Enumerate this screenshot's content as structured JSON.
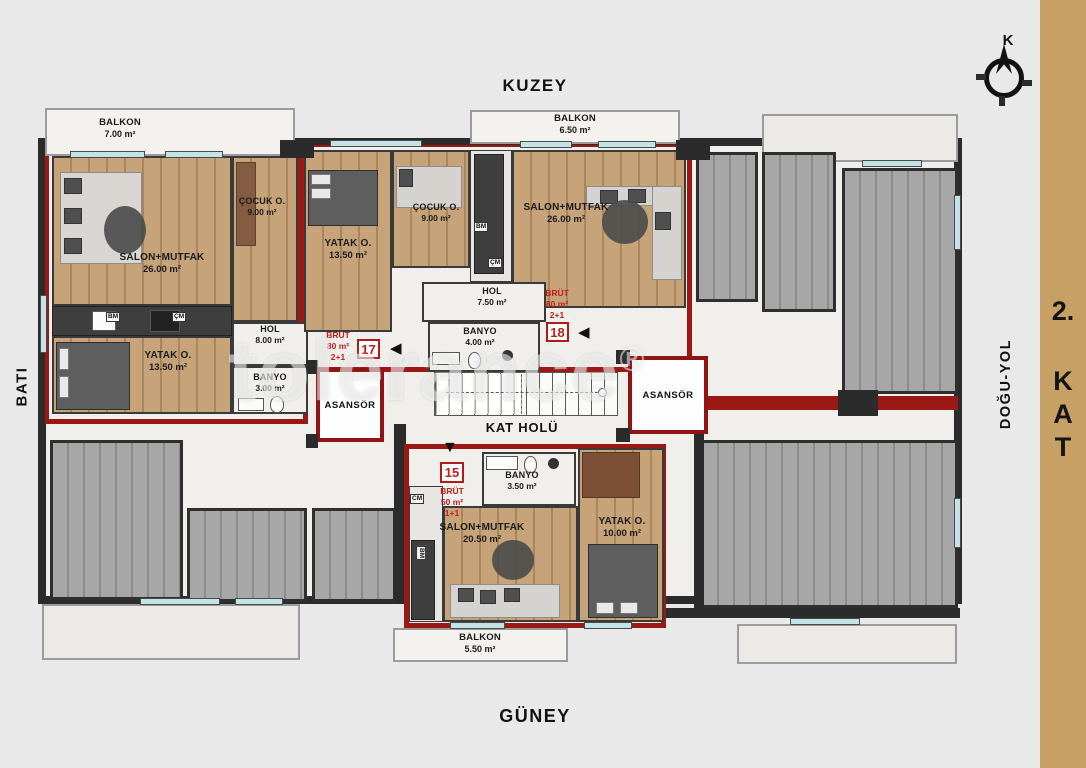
{
  "orientation": {
    "north": "KUZEY",
    "south": "GÜNEY",
    "west": "BATI",
    "east": "DOĞU-YOL"
  },
  "floor_label": {
    "full": "2. KAT",
    "lines": [
      "2.",
      "K",
      "A",
      "T"
    ]
  },
  "compass": {
    "letter": "K"
  },
  "watermark": {
    "text": "tolerance",
    "reg": "®"
  },
  "common_areas": {
    "hall": "KAT HOLÜ",
    "elevator": "ASANSÖR"
  },
  "units": {
    "u17": {
      "no": "17",
      "brut_label": "BRÜT",
      "gross_area": "80 m²",
      "layout": "2+1",
      "entry_arrow": "◀"
    },
    "u18": {
      "no": "18",
      "brut_label": "BRÜT",
      "gross_area": "80 m²",
      "layout": "2+1",
      "entry_arrow": "◀"
    },
    "u15": {
      "no": "15",
      "brut_label": "BRÜT",
      "gross_area": "50 m²",
      "layout": "1+1",
      "entry_arrow": "▼"
    }
  },
  "rooms": {
    "balkon17": {
      "name": "BALKON",
      "area": "7.00 m²"
    },
    "salon17": {
      "name": "SALON+MUTFAK",
      "area": "26.00 m²"
    },
    "cocuk17": {
      "name": "ÇOCUK O.",
      "area": "9.00 m²"
    },
    "yatak17": {
      "name": "YATAK O.",
      "area": "13.50 m²"
    },
    "hol17": {
      "name": "HOL",
      "area": "8.00 m²"
    },
    "banyo17": {
      "name": "BANYO",
      "area": "3.00 m²"
    },
    "balkon18": {
      "name": "BALKON",
      "area": "6.50 m²"
    },
    "yatak18": {
      "name": "YATAK O.",
      "area": "13.50 m²"
    },
    "cocuk18": {
      "name": "ÇOCUK O.",
      "area": "9.00 m²"
    },
    "salon18": {
      "name": "SALON+MUTFAK",
      "area": "26.00 m²"
    },
    "hol18": {
      "name": "HOL",
      "area": "7.50 m²"
    },
    "banyo18": {
      "name": "BANYO",
      "area": "4.00 m²"
    },
    "banyo15": {
      "name": "BANYO",
      "area": "3.50 m²"
    },
    "salon15": {
      "name": "SALON+MUTFAK",
      "area": "20.50 m²"
    },
    "yatak15": {
      "name": "YATAK O.",
      "area": "10.00 m²"
    },
    "balkon15": {
      "name": "BALKON",
      "area": "5.50 m²"
    }
  },
  "appliances": {
    "dishwasher": "BM",
    "washer": "ÇM",
    "washer_alt": "CM"
  },
  "colors": {
    "accent_red": "#9b1915",
    "wood": "#c6a379",
    "gray_floor": "#a7a7a7",
    "tan_strip": "#c7a066",
    "wall": "#2b2b2b",
    "window": "#c2e4e6"
  }
}
